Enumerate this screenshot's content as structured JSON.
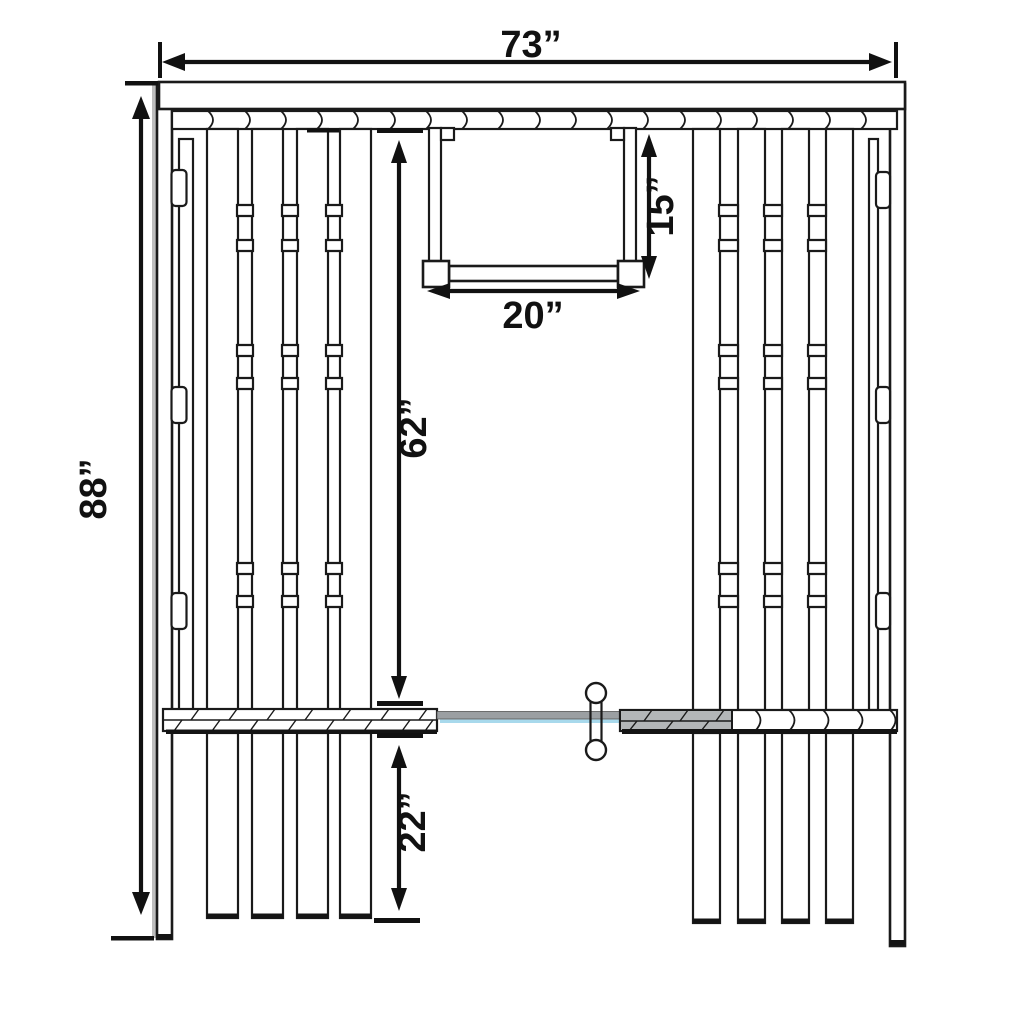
{
  "diagram": {
    "dimension_labels": {
      "overall_width": "73”",
      "overall_height": "88”",
      "hanger_height": "15”",
      "hanger_width": "20”",
      "upper_panel_height": "62”",
      "lower_panel_height": "22”"
    },
    "colors": {
      "line": "#1a1a1a",
      "post_shadow_gray": "#bdbdbd",
      "rail_bar_gray": "#9b9fa2",
      "rail_gray_section": "#b3b6b8",
      "water_line_blue": "#a8d9ec",
      "shadow_dark": "#141414"
    }
  }
}
